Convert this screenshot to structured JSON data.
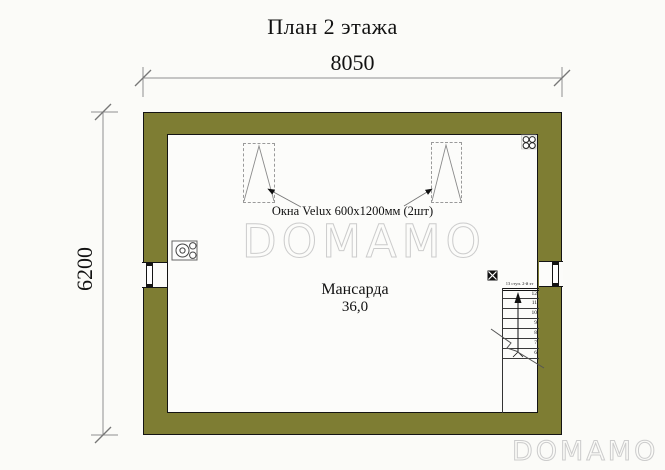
{
  "title": "План 2 этажа",
  "dimensions": {
    "width": "8050",
    "height": "6200"
  },
  "room": {
    "name": "Мансарда",
    "area": "36,0"
  },
  "annotations": {
    "velux_windows": "Окна Velux 600х1200мм (2шт)",
    "stairs_note": "13 ступ. 2-й эт"
  },
  "stairs": {
    "numbers": [
      "12",
      "11",
      "10",
      "9",
      "8",
      "7",
      "6"
    ]
  },
  "watermarks": {
    "center": "DOMAMO",
    "corner": "DOMAMO"
  },
  "icons": {
    "stove": "stove-burners-icon",
    "flue": "chimney-flue-icon",
    "vent": "vent-shaft-icon"
  },
  "colors": {
    "wall_fill": "#7e7d33",
    "outline": "#141414",
    "dimension_line": "#8f8f8f",
    "watermark": "#cccccc",
    "background": "#fbfbf8"
  }
}
